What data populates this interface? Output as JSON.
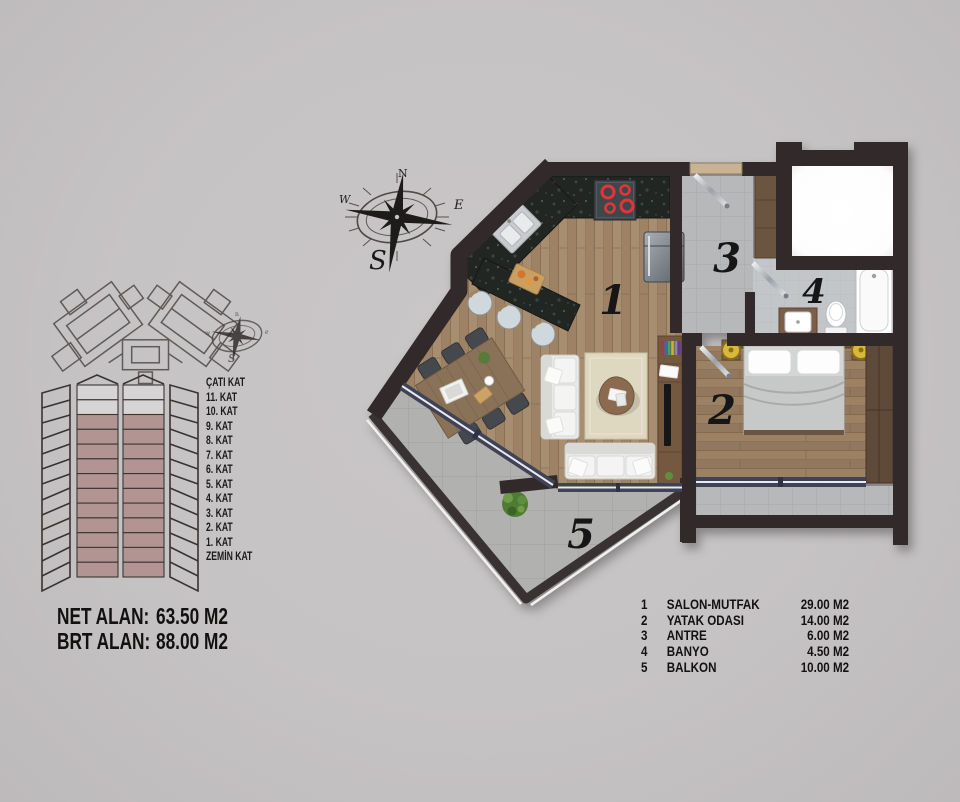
{
  "title": "Apartment floor plan sheet",
  "compass": {
    "n": "N",
    "e": "E",
    "s": "S",
    "w": "W"
  },
  "compass_small": {
    "n": "n",
    "e": "e",
    "s": "S",
    "w": "w"
  },
  "stack": {
    "floors": [
      "ÇATI KAT",
      "11. KAT",
      "10. KAT",
      "9. KAT",
      "8. KAT",
      "7. KAT",
      "6. KAT",
      "5. KAT",
      "4. KAT",
      "3. KAT",
      "2. KAT",
      "1. KAT",
      "ZEMİN KAT"
    ],
    "highlight_from": "10. KAT",
    "highlight_color": "#b29492"
  },
  "areas": {
    "rows": [
      {
        "label": "NET ALAN:",
        "value": "63.50 M2"
      },
      {
        "label": "BRT ALAN:",
        "value": "88.00 M2"
      }
    ]
  },
  "legend": {
    "rows": [
      {
        "num": "1",
        "name": "SALON-MUTFAK",
        "area": "29.00 M2"
      },
      {
        "num": "2",
        "name": "YATAK ODASI",
        "area": "14.00 M2"
      },
      {
        "num": "3",
        "name": "ANTRE",
        "area": "6.00 M2"
      },
      {
        "num": "4",
        "name": "BANYO",
        "area": "4.50 M2"
      },
      {
        "num": "5",
        "name": "BALKON",
        "area": "10.00 M2"
      }
    ]
  },
  "plan": {
    "room_numbers": [
      "1",
      "2",
      "3",
      "4",
      "5"
    ],
    "colors": {
      "background": "#c6c3c4",
      "wall": "#322c29",
      "wood_floor": "#a78e70",
      "bedroom_floor": "#9c8164",
      "granite_counter": "#242822",
      "tile_gray": "#b7b8b9",
      "balcony_tile": "#b1b1af",
      "window_frame": "#3f4257",
      "stack_highlight": "#b29492",
      "lamp_yellow": "#d9b93e",
      "plant_green": "#4f7c33",
      "stove_red": "#e23437"
    }
  }
}
